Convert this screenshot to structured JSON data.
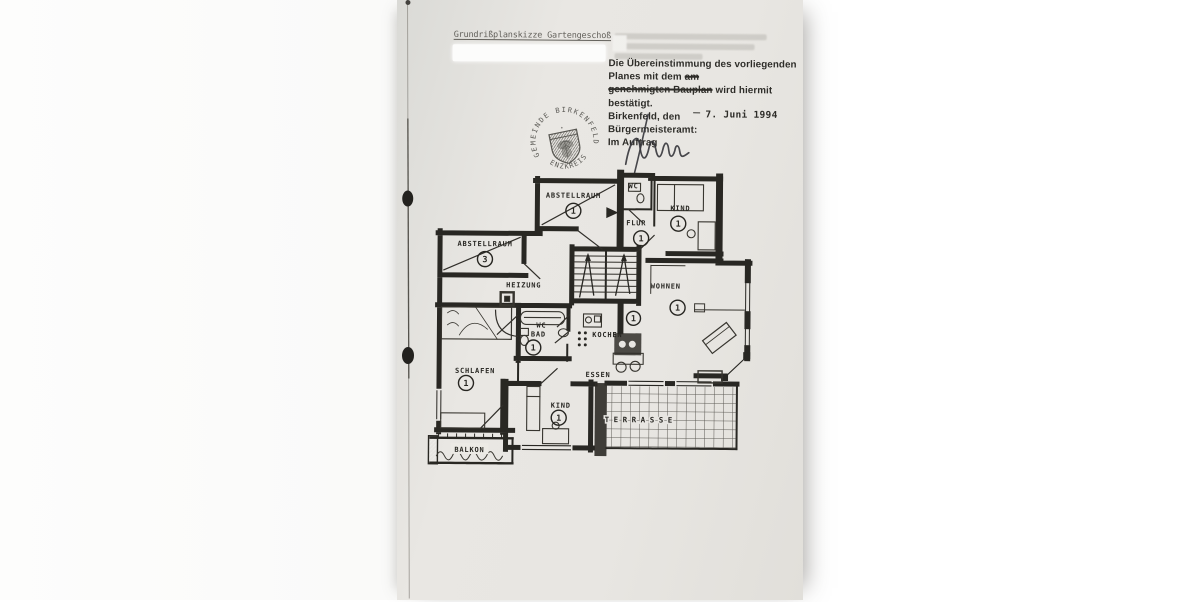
{
  "colors": {
    "paper": "#e8e6e2",
    "ink": "#1a1915",
    "stamp_ink": "#45443f"
  },
  "document": {
    "header_label": "Grundrißplanskizze Gartengeschoß",
    "approval": {
      "line1": "Die Übereinstimmung des vorliegenden",
      "line2_pre": "Planes mit dem",
      "line2_struck": "am",
      "line3_struck": "genehmigten Bauplan",
      "line3_post": "wird hiermit",
      "line4": "bestätigt.",
      "place_label": "Birkenfeld, den",
      "date": "7. Juni 1994",
      "office": "Bürgermeisteramt:",
      "by_order": "Im Auftrag"
    },
    "stamp": {
      "ring_top": "GEMEINDE BIRKENFELD",
      "ring_bottom": "ENZKREIS",
      "crest_mark": "✦"
    }
  },
  "floor_plan": {
    "rooms": {
      "abstellraum1": {
        "label": "ABSTELLRAUM",
        "number": "1"
      },
      "wc_top": {
        "label": "WC"
      },
      "flur": {
        "label": "FLUR",
        "number": "1"
      },
      "kind_top": {
        "label": "KIND",
        "number": "1"
      },
      "abstellraum3": {
        "label": "ABSTELLRAUM",
        "number": "3"
      },
      "heizung": {
        "label": "HEIZUNG"
      },
      "wohnen": {
        "label": "WOHNEN",
        "number": "1"
      },
      "bad": {
        "label": "WC",
        "label2": "BAD",
        "number": "1"
      },
      "kochen": {
        "label": "KOCHEN",
        "number": "1"
      },
      "schlafen": {
        "label": "SCHLAFEN",
        "number": "1"
      },
      "essen": {
        "label": "ESSEN"
      },
      "kind_bottom": {
        "label": "KIND",
        "number": "1"
      },
      "terrasse": {
        "label": "TERRASSE"
      },
      "balkon": {
        "label": "BALKON"
      }
    }
  }
}
